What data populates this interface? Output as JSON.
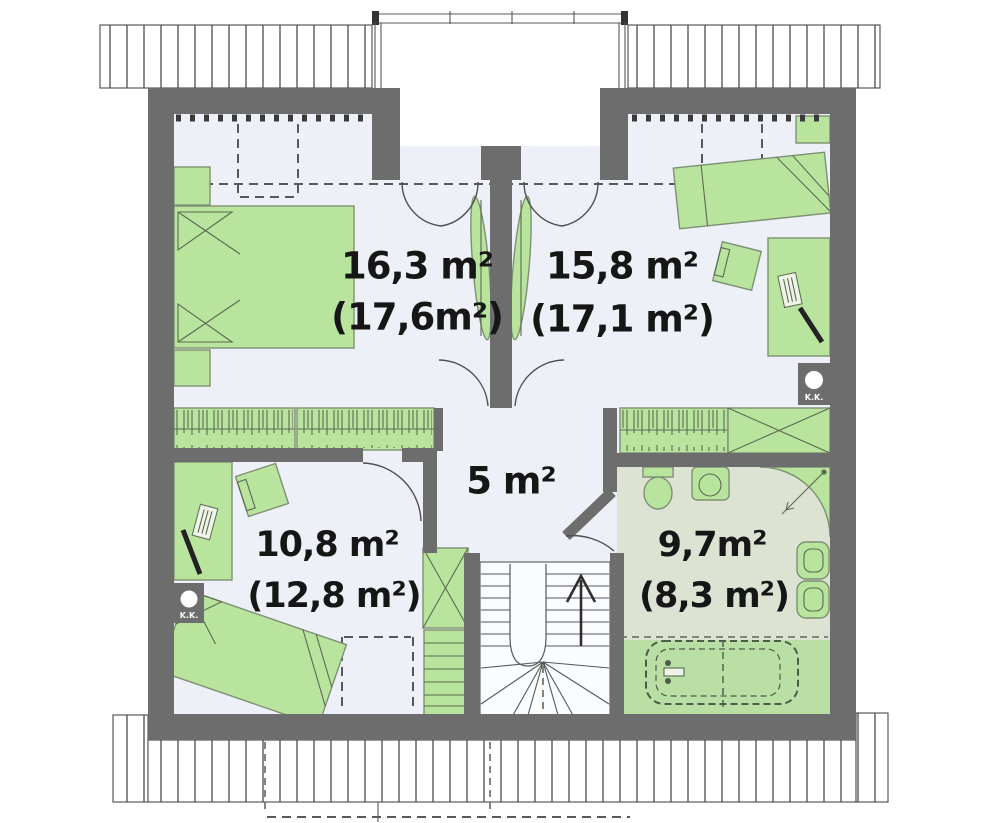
{
  "plan": {
    "type": "attic-floor-plan",
    "rooms": [
      {
        "id": "bedroom-left",
        "area": "16,3 m²",
        "area_note": "(17,6m²)"
      },
      {
        "id": "bedroom-right",
        "area": "15,8 m²",
        "area_note": "(17,1 m²)"
      },
      {
        "id": "hall",
        "area": "5 m²",
        "area_note": ""
      },
      {
        "id": "bedroom-lower-left",
        "area": "10,8 m²",
        "area_note": "(12,8 m²)"
      },
      {
        "id": "bathroom",
        "area": "9,7m²",
        "area_note": "(8,3 m²)"
      }
    ],
    "chimney_label": "K.K.",
    "colors": {
      "wall": "#6d6d6d",
      "floor": "#edf1f7",
      "furn": "#b9e49e",
      "furnline": "#7e9073",
      "bathfloor": "#dde3d3",
      "bathgreen": "#b9dfa4",
      "line": "#4f4f4f",
      "text": "#161616"
    }
  }
}
